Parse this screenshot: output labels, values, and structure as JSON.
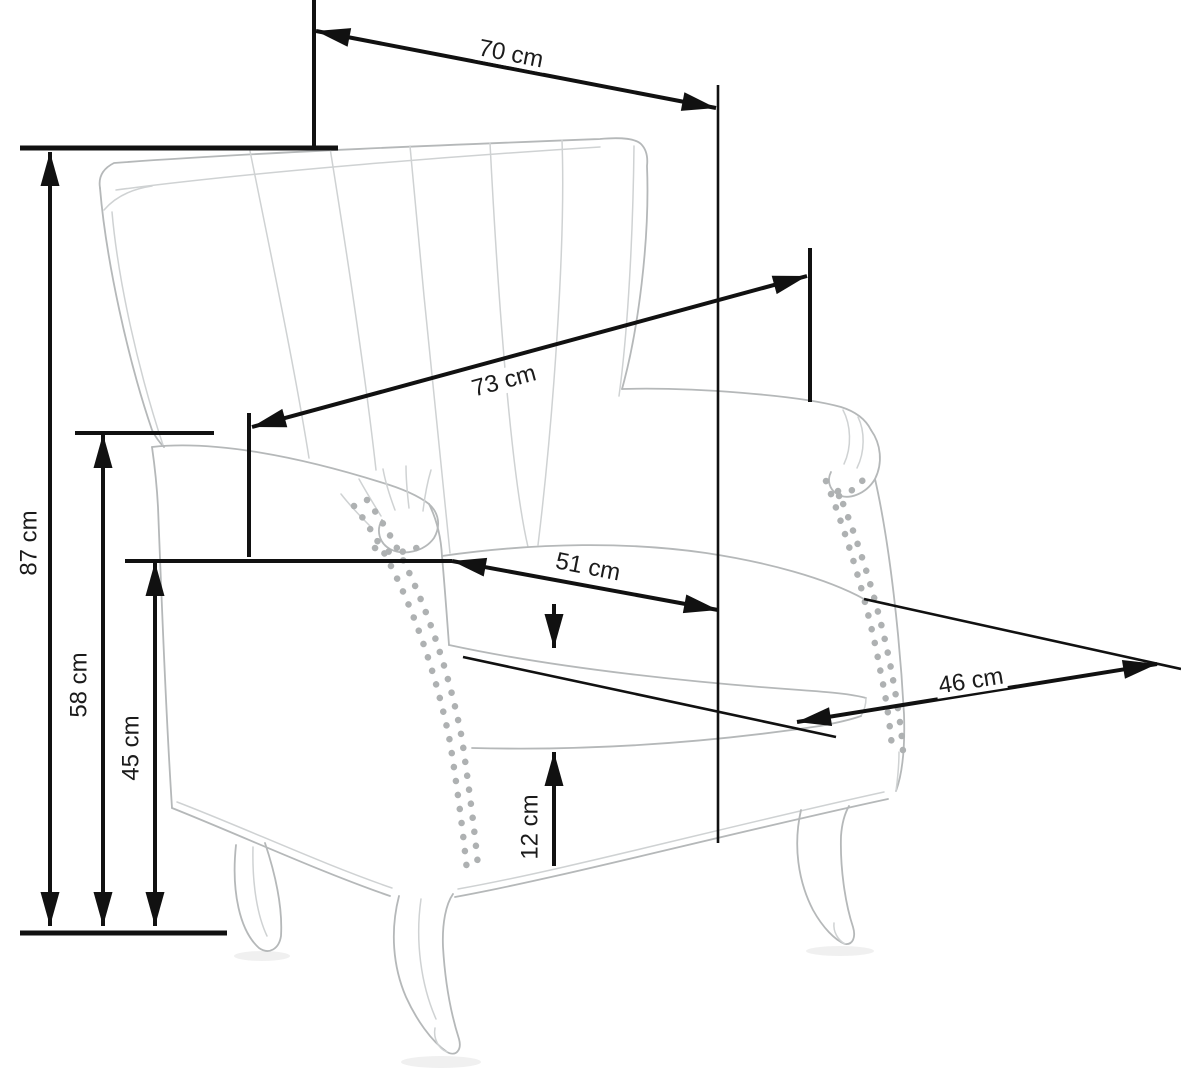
{
  "diagram": {
    "subject": "Wingback armchair dimensional line drawing",
    "units": "cm",
    "colors": {
      "background": "#ffffff",
      "dimension_lines": "#111111",
      "drawing_stroke": "#b5b8b9",
      "text": "#1b1b1b"
    },
    "dimensions": {
      "d70": {
        "label": "70 cm",
        "value": 70
      },
      "d73": {
        "label": "73 cm",
        "value": 73
      },
      "d51": {
        "label": "51 cm",
        "value": 51
      },
      "d46": {
        "label": "46 cm",
        "value": 46
      },
      "d87": {
        "label": "87 cm",
        "value": 87
      },
      "d58": {
        "label": "58 cm",
        "value": 58
      },
      "d45": {
        "label": "45 cm",
        "value": 45
      },
      "d12": {
        "label": "12 cm",
        "value": 12
      }
    }
  }
}
